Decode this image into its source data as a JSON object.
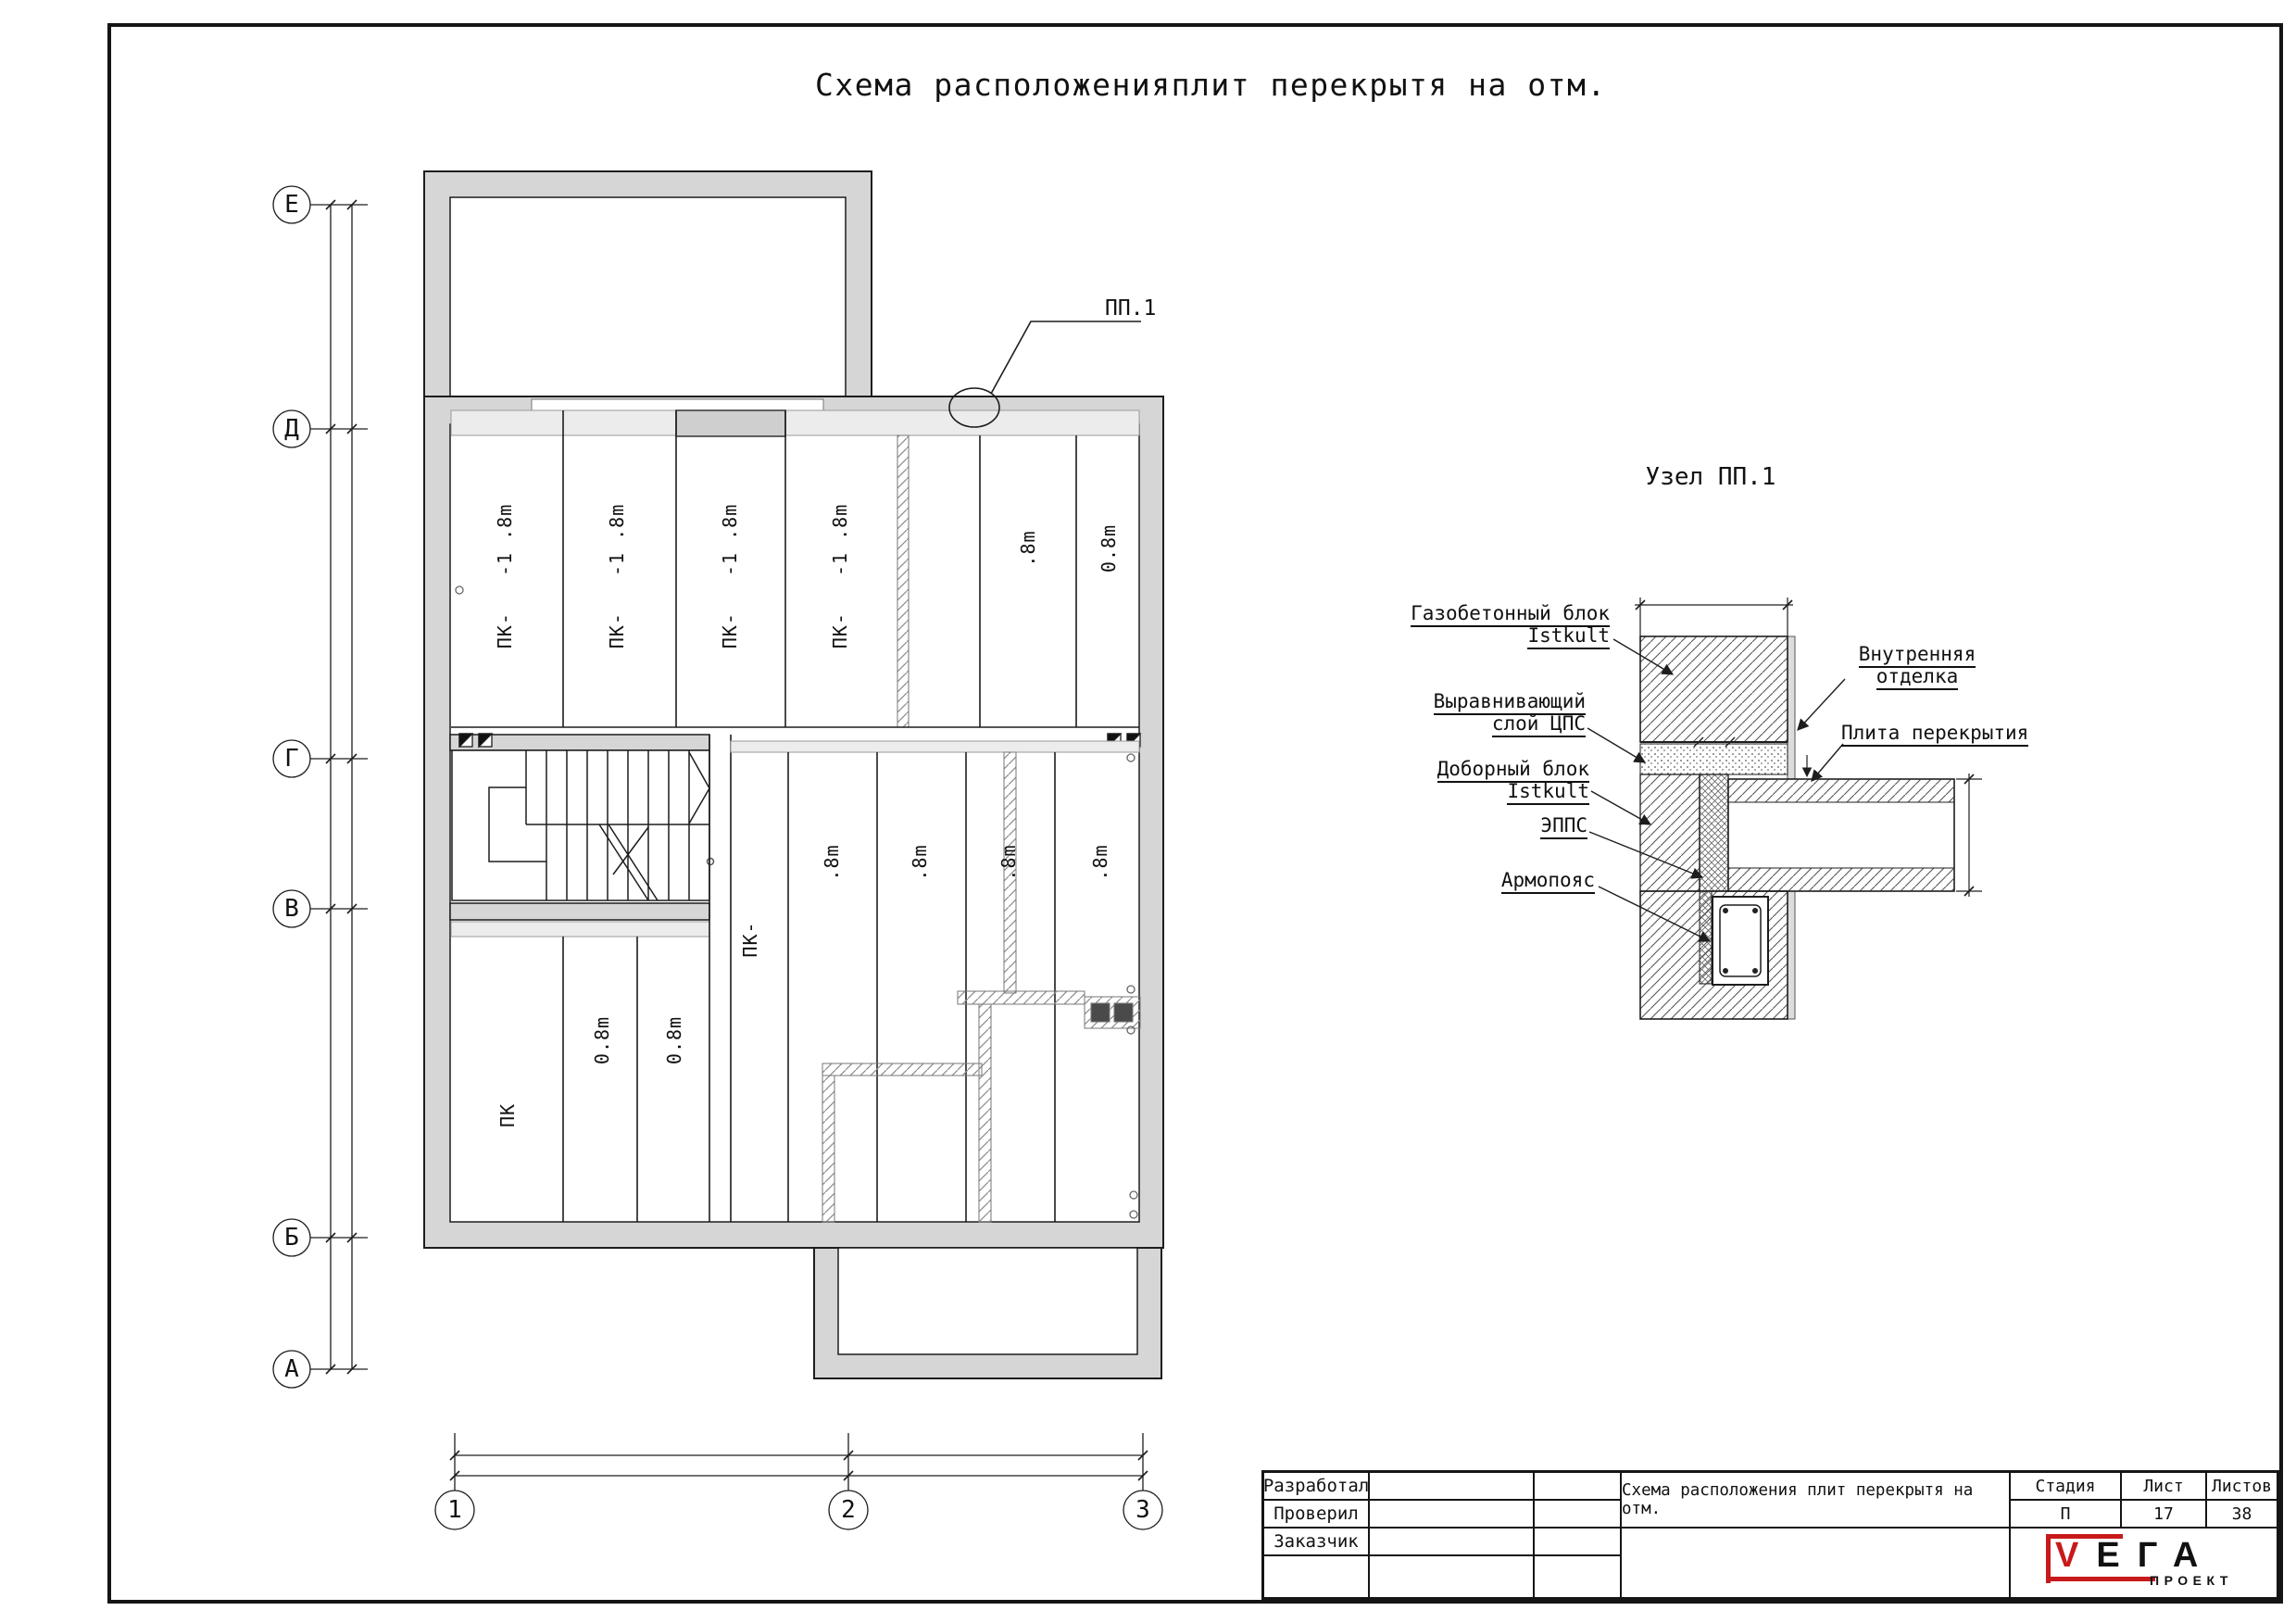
{
  "page": {
    "title": "Схема расположенияплит перекрытя на отм."
  },
  "plan": {
    "row_axes": [
      "Е",
      "Д",
      "Г",
      "В",
      "Б",
      "А"
    ],
    "col_axes": [
      "1",
      "2",
      "3"
    ],
    "callout": "ПП.1",
    "labels": {
      "pk_18": "ПК-   -1 .8m",
      "m8": ".8m",
      "m08": "0.8m",
      "pk_dash": "ПК-",
      "pk": "ПК"
    }
  },
  "detail": {
    "title": "Узел ПП.1",
    "labels": {
      "gas_1": "Газобетонный блок",
      "gas_2": "Istkult",
      "screed_1": "Выравнивающий",
      "screed_2": "слой ЦПС",
      "add_1": "Доборный блок",
      "add_2": "Istkult",
      "epps": "ЭППС",
      "armo": "Армопояс",
      "finish_1": "Внутренняя",
      "finish_2": "отделка",
      "slab": "Плита перекрытия"
    }
  },
  "titleblock": {
    "developed": "Разработал",
    "checked": "Проверил",
    "customer": "Заказчик",
    "doc_title": "Схема расположения плит перекрытя на отм.",
    "stage_label": "Стадия",
    "sheet_label": "Лист",
    "sheets_label": "Листов",
    "stage": "П",
    "sheet": "17",
    "sheets": "38",
    "logo": {
      "v": "V",
      "rest": "ЕГА",
      "sub": "ПРОЕКТ"
    }
  },
  "colors": {
    "wall": "#d6d6d6",
    "slab_band": "#ececec",
    "line": "#1d1d1d",
    "logo_red": "#c81a1a"
  }
}
